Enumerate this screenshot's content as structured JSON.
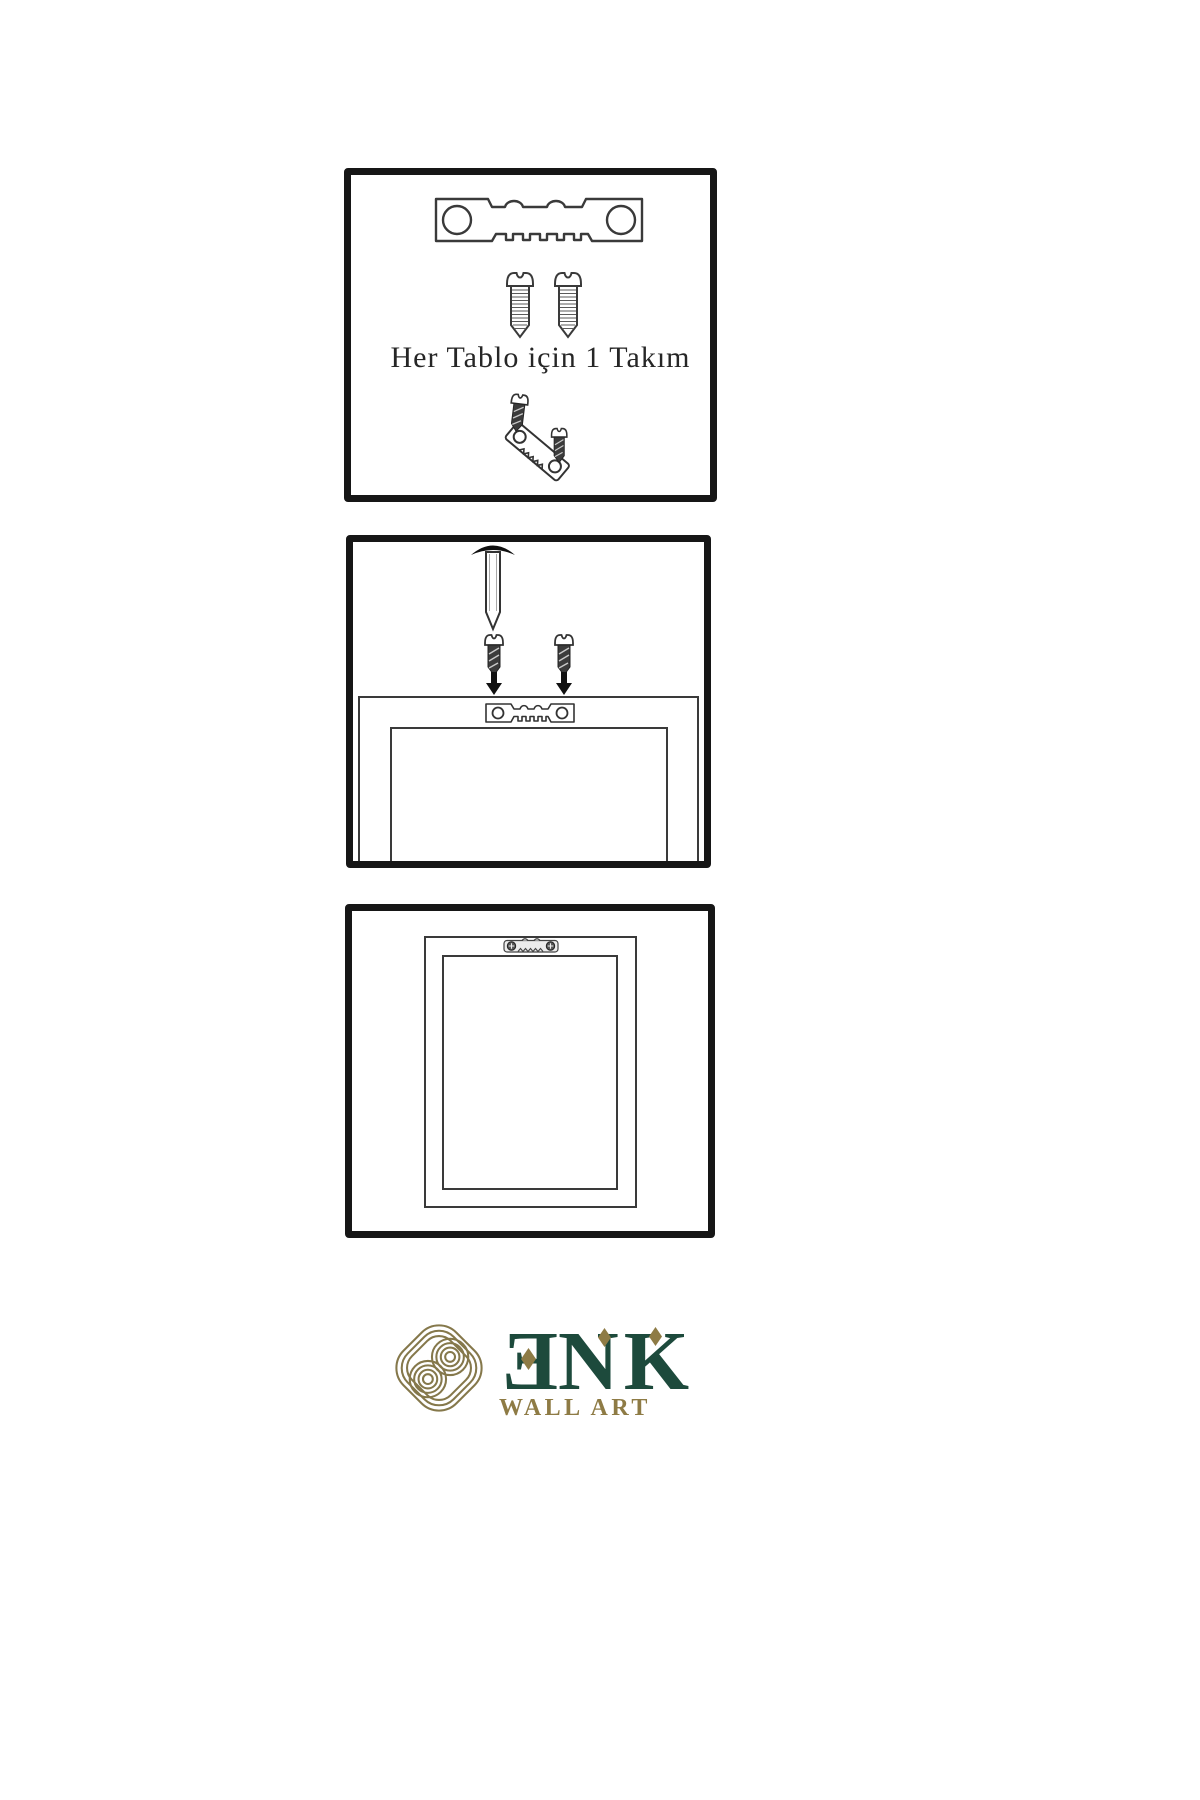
{
  "sheet": {
    "background": "#ffffff",
    "type": "wall-art-hanging-instructions"
  },
  "palette": {
    "panel_border": "#161616",
    "line": "#3a3a3a",
    "dark_fill": "#3b3b3b",
    "logo_green": "#1d4a3c",
    "logo_gold": "#8e7b45",
    "knot_gold": "#85784b"
  },
  "panels": [
    {
      "id": "hardware-kit",
      "caption": "Her Tablo için 1 Takım",
      "illustrations": [
        "sawtooth-hanger-icon",
        "screw-icon",
        "screw-icon",
        "screw-into-hanger-icon"
      ]
    },
    {
      "id": "wall-mounting",
      "illustrations": [
        "nail-icon",
        "screw-icon",
        "screw-icon",
        "arrow-down-icon",
        "arrow-down-icon",
        "frame-back-icon",
        "sawtooth-hanger-icon"
      ]
    },
    {
      "id": "hung-frame",
      "illustrations": [
        "frame-front-icon",
        "sawtooth-hanger-icon"
      ]
    }
  ],
  "logo": {
    "mark": "knot-icon",
    "letters": {
      "e": "E",
      "n": "N",
      "k": "K"
    },
    "subtitle": "WALL ART"
  }
}
